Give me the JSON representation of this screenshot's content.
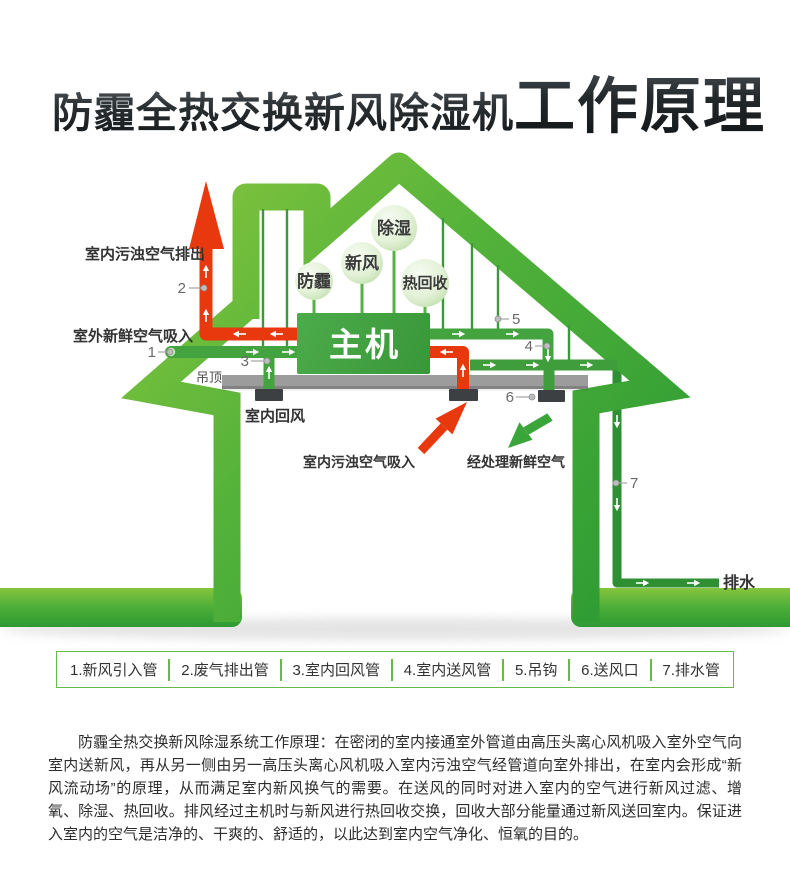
{
  "title": {
    "part1": "防霾全热交换新风除湿机",
    "part2": "工作原理"
  },
  "diagram": {
    "unit_label": "主机",
    "bubbles": [
      {
        "label": "防霾"
      },
      {
        "label": "新风"
      },
      {
        "label": "除湿"
      },
      {
        "label": "热回收"
      }
    ],
    "labels": {
      "exhaust_out": "室内污浊空气排出",
      "fresh_in": "室外新鲜空气吸入",
      "ceiling": "吊顶",
      "return_air": "室内回风",
      "dirty_intake": "室内污浊空气吸入",
      "treated_fresh": "经处理新鲜空气",
      "drain": "排水"
    },
    "callout_numbers": [
      "1",
      "2",
      "3",
      "4",
      "5",
      "6",
      "7"
    ],
    "colors": {
      "house_green": "#4aad3a",
      "pipe_green": "#43a33e",
      "pipe_red": "#e8380d",
      "unit_green": "#43a143",
      "ceiling_gray": "#9c9c9c"
    }
  },
  "legend": {
    "items": [
      "1.新风引入管",
      "2.废气排出管",
      "3.室内回风管",
      "4.室内送风管",
      "5.吊钩",
      "6.送风口",
      "7.排水管"
    ]
  },
  "description": {
    "text": "防霾全热交换新风除湿系统工作原理：在密闭的室内接通室外管道由高压头离心风机吸入室外空气向室内送新风，再从另一侧由另一高压头离心风机吸入室内污浊空气经管道向室外排出，在室内会形成“新风流动场”的原理，从而满足室内新风换气的需要。在送风的同时对进入室内的空气进行新风过滤、增氧、除湿、热回收。排风经过主机时与新风进行热回收交换，回收大部分能量通过新风送回室内。保证进入室内的空气是洁净的、干爽的、舒适的，以此达到室内空气净化、恒氧的目的。"
  }
}
